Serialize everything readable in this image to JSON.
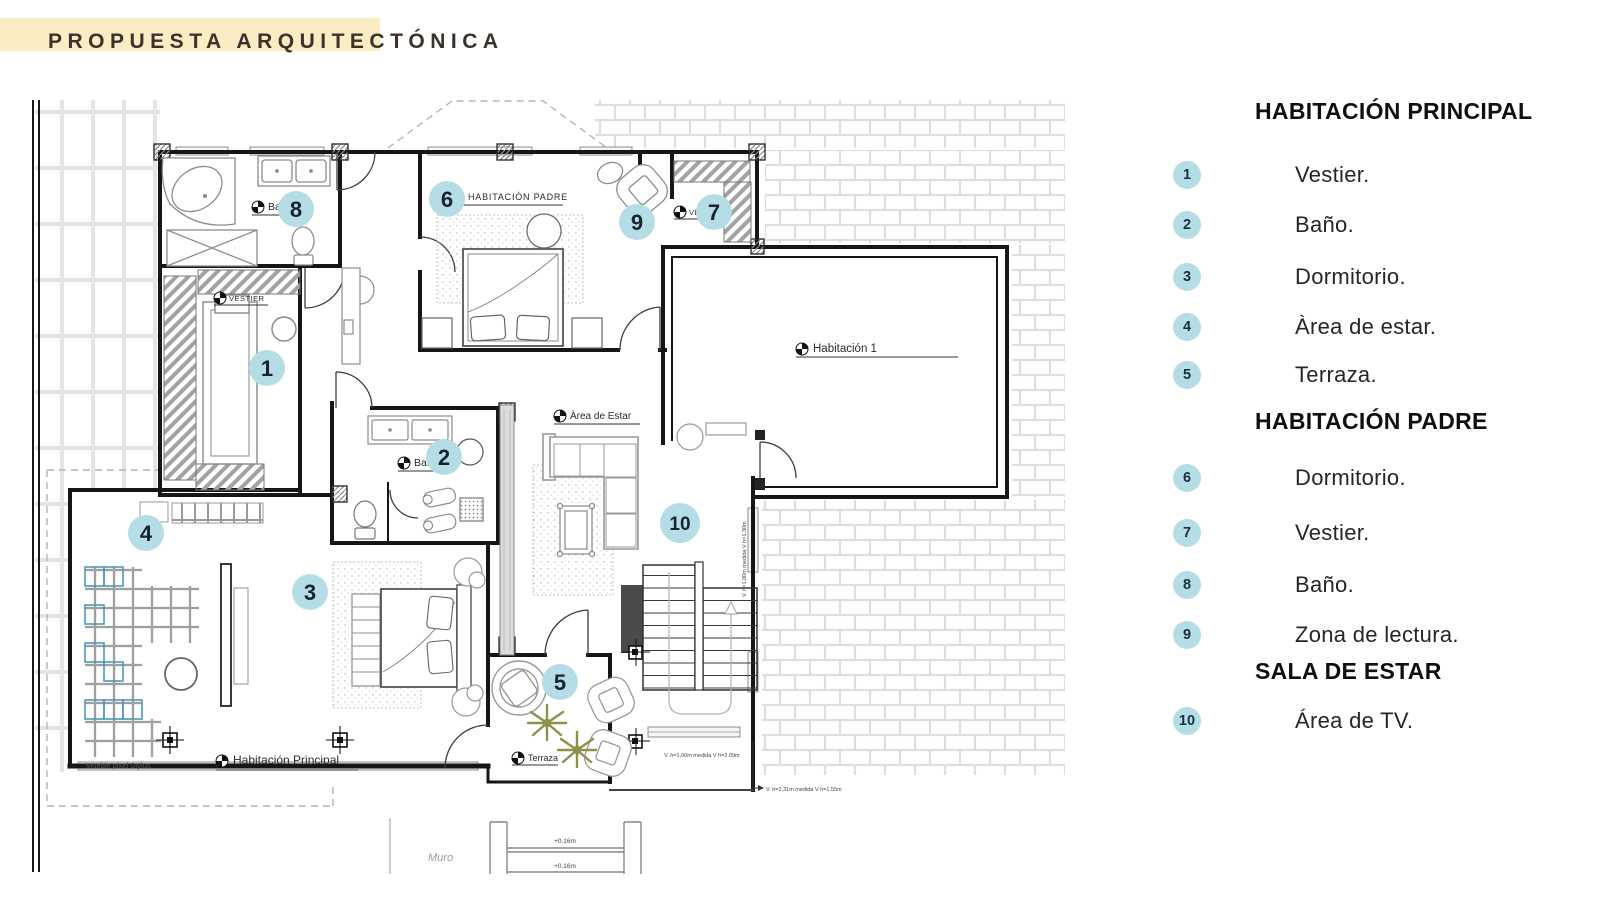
{
  "title": "PROPUESTA ARQUITECTÓNICA",
  "colors": {
    "accent_yellow": "#FAEDC4",
    "marker_blue": "#B5DDE6",
    "plant_olive": "#8E9148",
    "pixel_blue": "#4B9AB8"
  },
  "plan": {
    "room_labels": {
      "bano_8": "Baño",
      "vestier_1": "VESTIER",
      "habitacion_padre": "HABITACIÒN PADRE",
      "vestier_7": "VESTIER",
      "habitacion_1": "Habitación 1",
      "bano_2": "Baño",
      "area_de_estar": "Àrea de Estar",
      "habitacion_principal": "Habitación Principal",
      "terraza": "Terraza",
      "mueble": "Mueble pixel Stylus",
      "muro": "Muro"
    },
    "markers": [
      "1",
      "2",
      "3",
      "4",
      "5",
      "6",
      "7",
      "8",
      "9",
      "10"
    ],
    "annotations": {
      "window_stair": "V. h=1,00m medida V h=2.09m",
      "window_side": "V. h=1,00m medida V h=1.30m",
      "window_low": "V. h=2,31m medida V h=1.55m",
      "step_1": "+0.16m",
      "step_2": "+0.16m"
    }
  },
  "legend": {
    "sections": [
      {
        "heading": "HABITACIÓN PRINCIPAL",
        "items": [
          {
            "num": "1",
            "label": "Vestier."
          },
          {
            "num": "2",
            "label": "Baño."
          },
          {
            "num": "3",
            "label": "Dormitorio."
          },
          {
            "num": "4",
            "label": "Àrea de estar."
          },
          {
            "num": "5",
            "label": "Terraza."
          }
        ]
      },
      {
        "heading": "HABITACIÓN PADRE",
        "items": [
          {
            "num": "6",
            "label": "Dormitorio."
          },
          {
            "num": "7",
            "label": "Vestier."
          },
          {
            "num": "8",
            "label": "Baño."
          },
          {
            "num": "9",
            "label": "Zona de lectura."
          }
        ]
      },
      {
        "heading": "SALA DE ESTAR",
        "items": [
          {
            "num": "10",
            "label": "Área de TV."
          }
        ]
      }
    ]
  }
}
